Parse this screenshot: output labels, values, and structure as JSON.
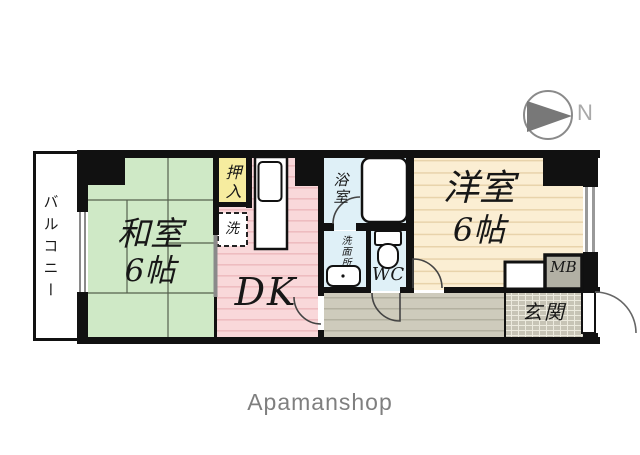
{
  "compass": {
    "north_label": "N"
  },
  "watermark": {
    "text": "Apamanshop"
  },
  "colors": {
    "wall": "#111111",
    "tatami_green": "#cfe9c6",
    "tatami_line": "#56614e",
    "dk_pink": "#f9d8da",
    "dk_stripe": "#eebcc0",
    "closet_yellow": "#f6ec9f",
    "water_blue": "#dff0f7",
    "western_beige": "#fbeed3",
    "western_stripe": "#e8d3ab",
    "hallway_gray": "#cecbbc",
    "hallway_stripe": "#b3b0a0",
    "genkan_gray": "#c7c4b6",
    "genkan_grid": "#eceade",
    "mb_gray": "#b2b0a4",
    "slider_gray": "#8a8a8a",
    "fixture_white": "#ffffff"
  },
  "rooms": {
    "balcony": {
      "label": "バルコニー"
    },
    "washitsu": {
      "name": "和室",
      "size": "6帖"
    },
    "oshiire": {
      "label": "押入"
    },
    "laundry": {
      "label": "洗"
    },
    "dk": {
      "label": "DK"
    },
    "bath": {
      "label": "浴室"
    },
    "washroom": {
      "label": "洗面所"
    },
    "wc": {
      "label": "WC"
    },
    "youshitsu": {
      "name": "洋室",
      "size": "6帖"
    },
    "mb": {
      "label": "MB"
    },
    "genkan": {
      "label": "玄関"
    }
  }
}
